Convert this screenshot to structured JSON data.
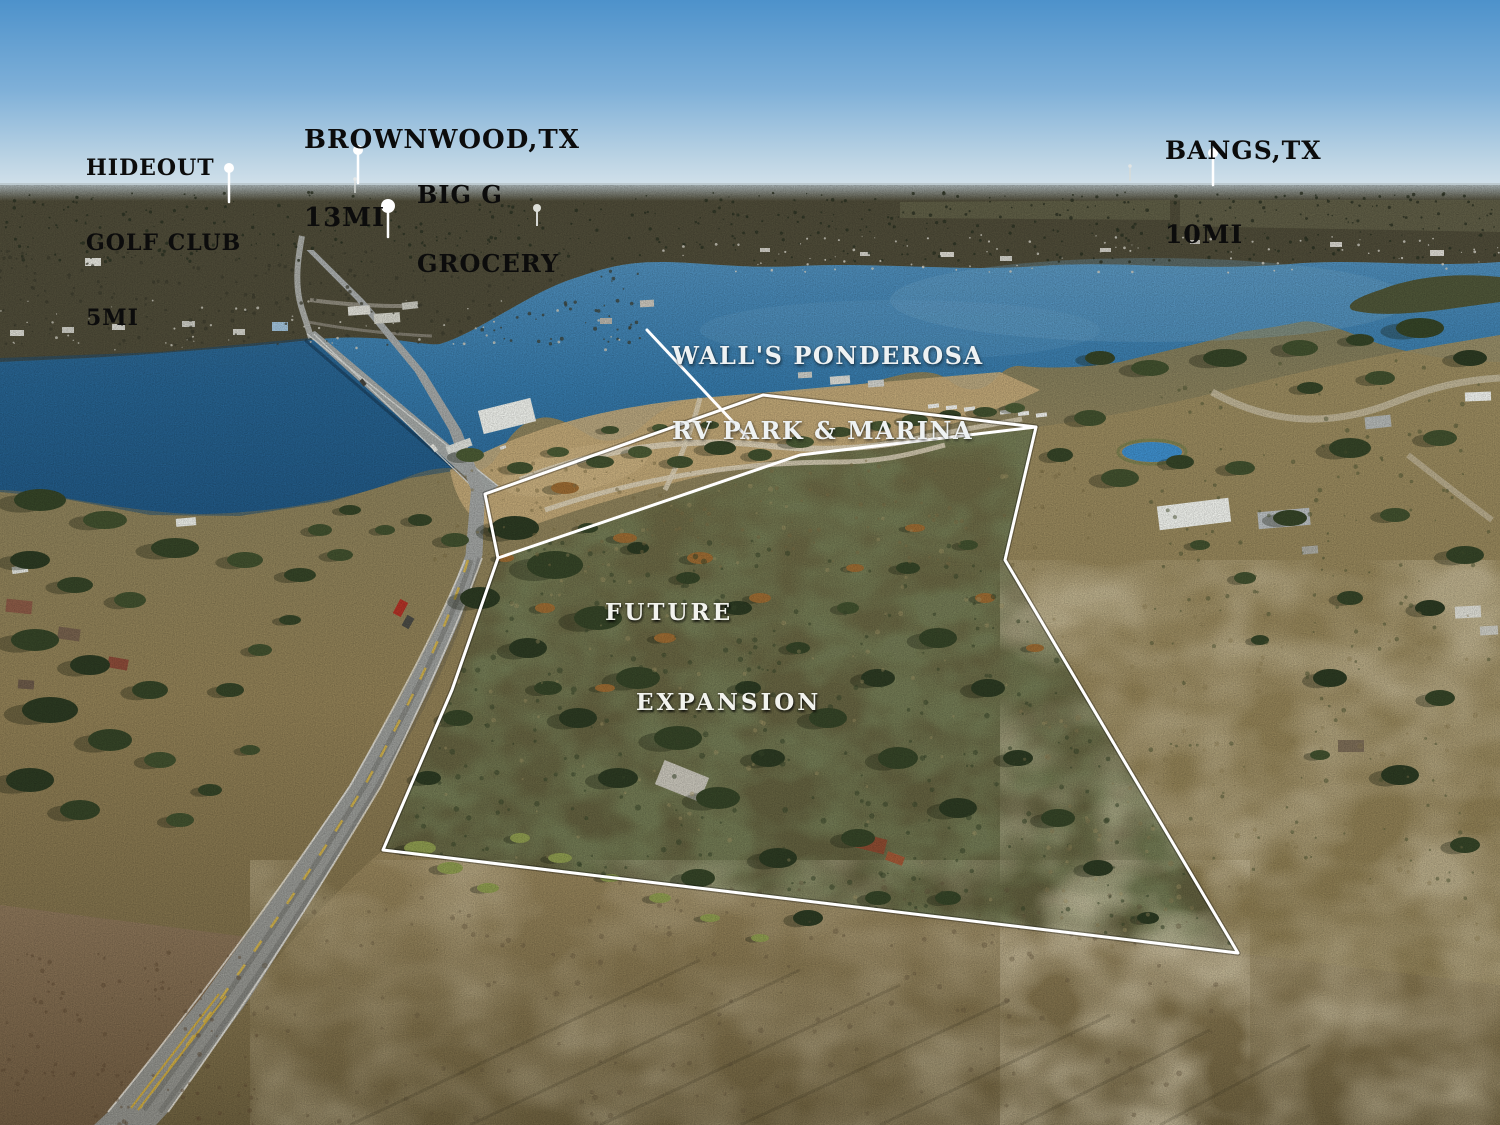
{
  "labels": {
    "hideout": {
      "line1": "HIDEOUT",
      "line2": "GOLF CLUB",
      "line3": "5MI"
    },
    "brownwood": {
      "line1": "BROWNWOOD,TX",
      "line2": "13MI"
    },
    "big_g": {
      "line1": "BIG G",
      "line2": "GROCERY"
    },
    "bangs": {
      "line1": "BANGS,TX",
      "line2": "10MI"
    },
    "rv_park": {
      "line1": "WALL'S PONDEROSA",
      "line2": "RV PARK & MARINA"
    },
    "future": {
      "line1": "FUTURE",
      "line2": "EXPANSION"
    }
  },
  "overlay": {
    "color": "#ffffff",
    "label_color": "#0c0c0c",
    "boundary_points": "485,494 763,395 1036,427 1005,560 1238,953 383,850 452,690 498,558",
    "divider_points": "498,558 800,455 1036,427",
    "leader_line": {
      "x1": 647,
      "y1": 330,
      "x2": 748,
      "y2": 438
    },
    "markers": [
      {
        "name": "hideout-golf-club",
        "x": 229,
        "y": 168,
        "r": 5,
        "stem": 34
      },
      {
        "name": "brownwood",
        "x": 358,
        "y": 150,
        "r": 5,
        "stem": 33
      },
      {
        "name": "big-g-grocery",
        "x": 388,
        "y": 206,
        "r": 7,
        "stem": 31
      },
      {
        "name": "bangs",
        "x": 1213,
        "y": 153,
        "r": 5,
        "stem": 32
      }
    ]
  }
}
